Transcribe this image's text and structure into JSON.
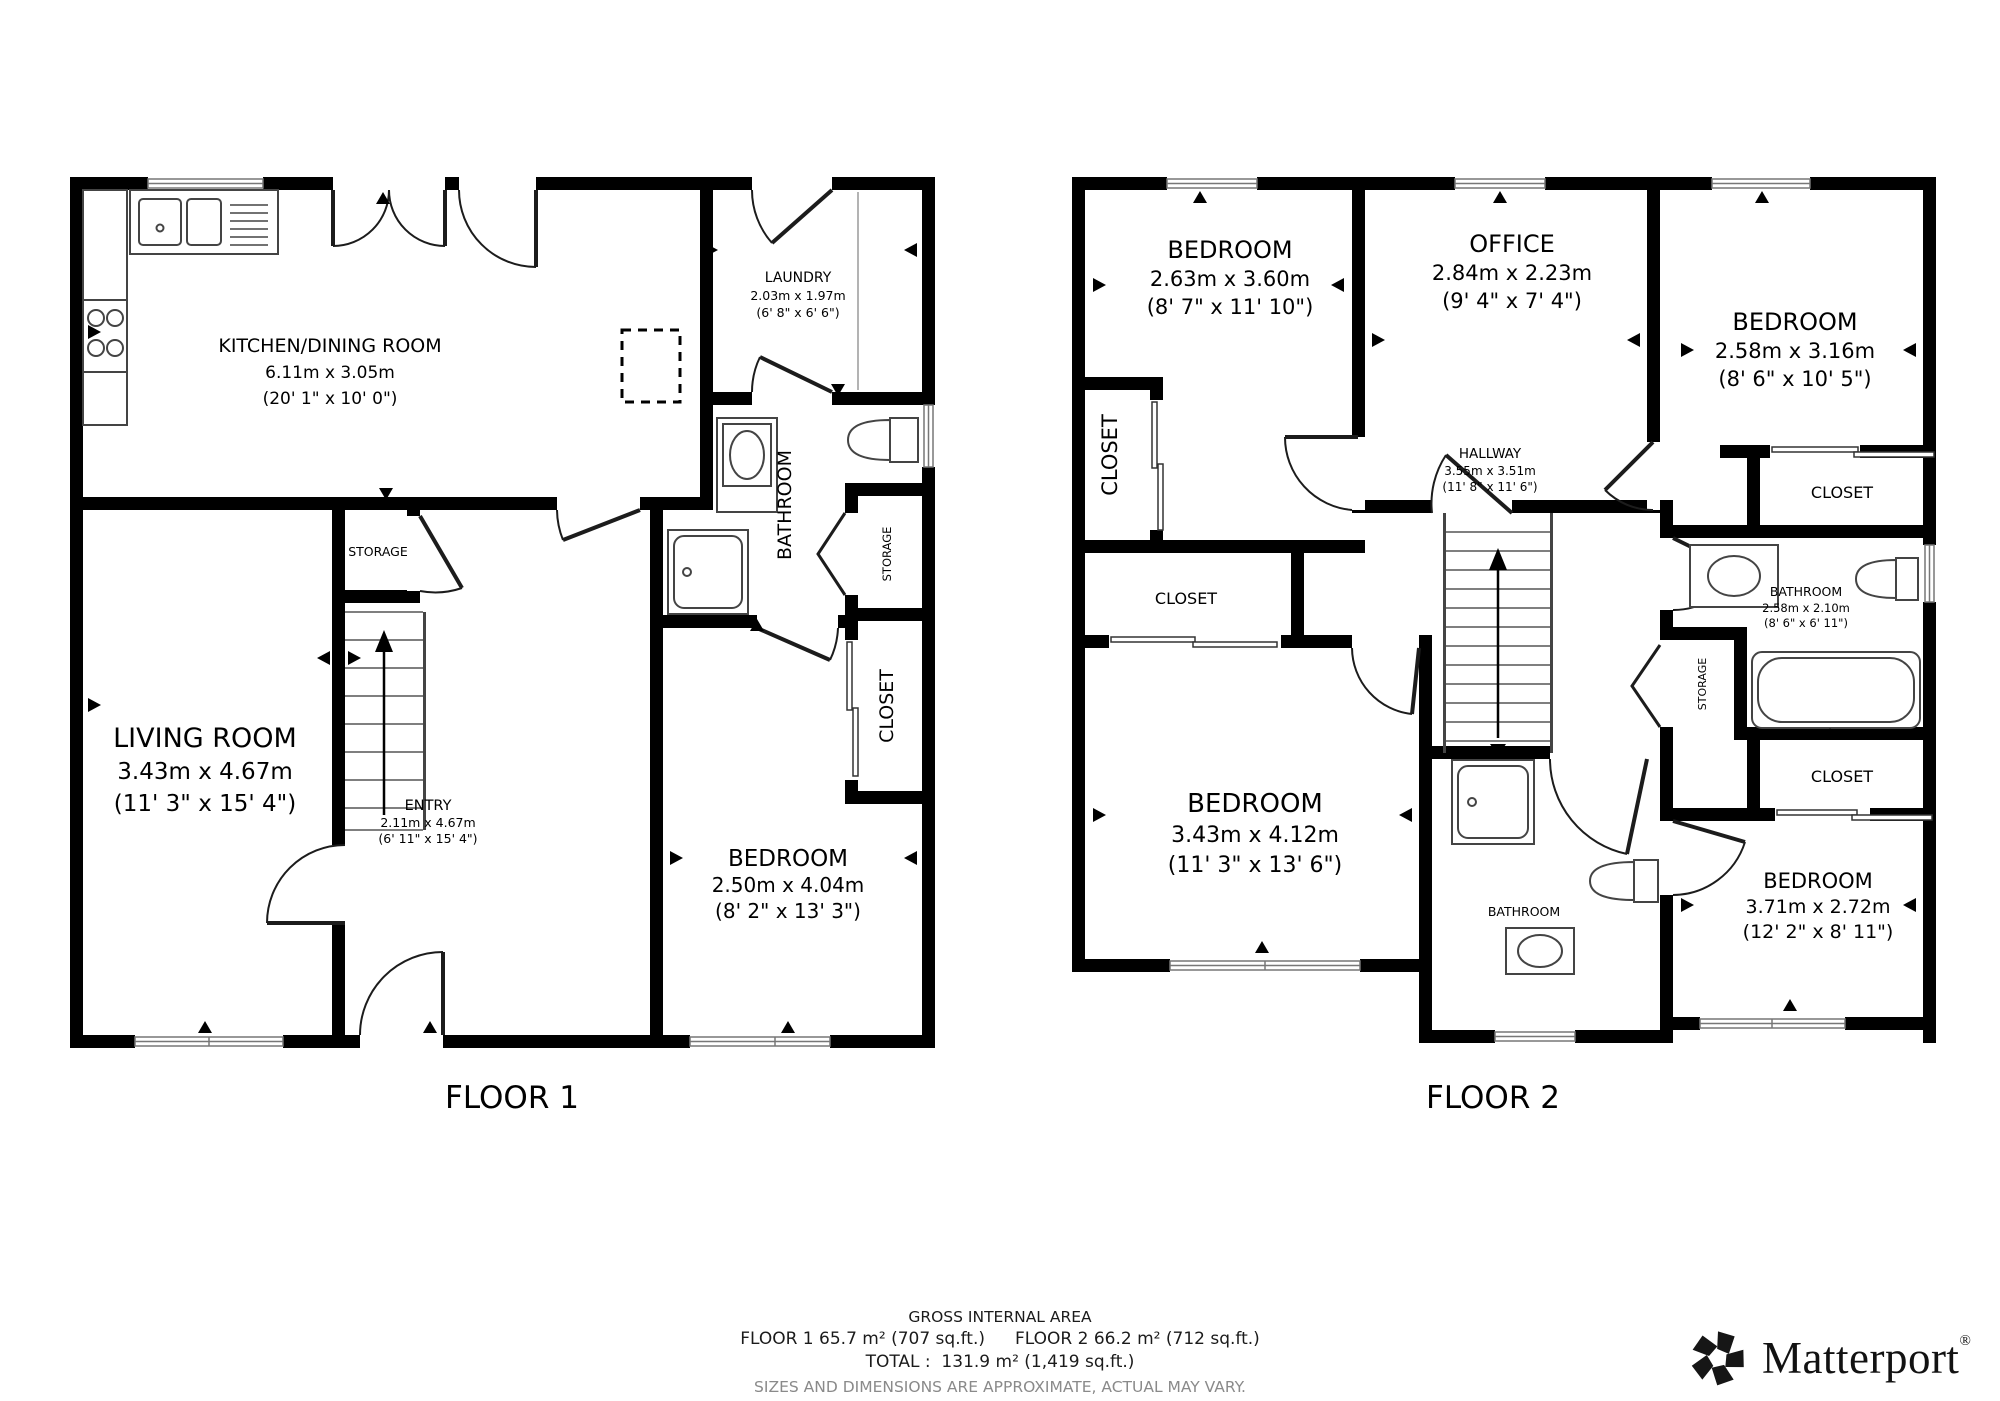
{
  "floor1": {
    "label": "FLOOR 1",
    "kitchen": {
      "name": "KITCHEN/DINING ROOM",
      "metric": "6.11m x 3.05m",
      "imperial": "(20' 1\" x 10' 0\")"
    },
    "laundry": {
      "name": "LAUNDRY",
      "metric": "2.03m x 1.97m",
      "imperial": "(6' 8\" x 6' 6\")"
    },
    "bathroom": {
      "name": "BATHROOM"
    },
    "storage_side": {
      "name": "STORAGE"
    },
    "storage_hall": {
      "name": "STORAGE"
    },
    "closet": {
      "name": "CLOSET"
    },
    "living": {
      "name": "LIVING ROOM",
      "metric": "3.43m x 4.67m",
      "imperial": "(11' 3\" x 15' 4\")"
    },
    "entry": {
      "name": "ENTRY",
      "metric": "2.11m x 4.67m",
      "imperial": "(6' 11\" x 15' 4\")"
    },
    "bedroom": {
      "name": "BEDROOM",
      "metric": "2.50m x 4.04m",
      "imperial": "(8' 2\" x 13' 3\")"
    }
  },
  "floor2": {
    "label": "FLOOR 2",
    "bedroom_tl": {
      "name": "BEDROOM",
      "metric": "2.63m x 3.60m",
      "imperial": "(8' 7\" x 11' 10\")"
    },
    "office": {
      "name": "OFFICE",
      "metric": "2.84m x 2.23m",
      "imperial": "(9' 4\" x 7' 4\")"
    },
    "bedroom_tr": {
      "name": "BEDROOM",
      "metric": "2.58m x 3.16m",
      "imperial": "(8' 6\" x 10' 5\")"
    },
    "hallway": {
      "name": "HALLWAY",
      "metric": "3.55m x 3.51m",
      "imperial": "(11' 8\" x 11' 6\")"
    },
    "closet_left": {
      "name": "CLOSET"
    },
    "closet_mid": {
      "name": "CLOSET"
    },
    "closet_tr": {
      "name": "CLOSET"
    },
    "closet_br": {
      "name": "CLOSET"
    },
    "storage": {
      "name": "STORAGE"
    },
    "bathroom_right": {
      "name": "BATHROOM",
      "metric": "2.58m x 2.10m",
      "imperial": "(8' 6\" x 6' 11\")"
    },
    "bathroom_mid": {
      "name": "BATHROOM"
    },
    "bedroom_bl": {
      "name": "BEDROOM",
      "metric": "3.43m x 4.12m",
      "imperial": "(11' 3\" x 13' 6\")"
    },
    "bedroom_br": {
      "name": "BEDROOM",
      "metric": "3.71m x 2.72m",
      "imperial": "(12' 2\" x 8' 11\")"
    }
  },
  "footer": {
    "title": "GROSS INTERNAL AREA",
    "floor1_area": "FLOOR 1 65.7 m² (707 sq.ft.)",
    "floor2_area": "FLOOR 2 66.2 m² (712 sq.ft.)",
    "total": "TOTAL :  131.9 m² (1,419 sq.ft.)",
    "disclaimer": "SIZES AND DIMENSIONS ARE APPROXIMATE, ACTUAL MAY VARY."
  },
  "brand": {
    "name": "Matterport",
    "registered": "®"
  }
}
